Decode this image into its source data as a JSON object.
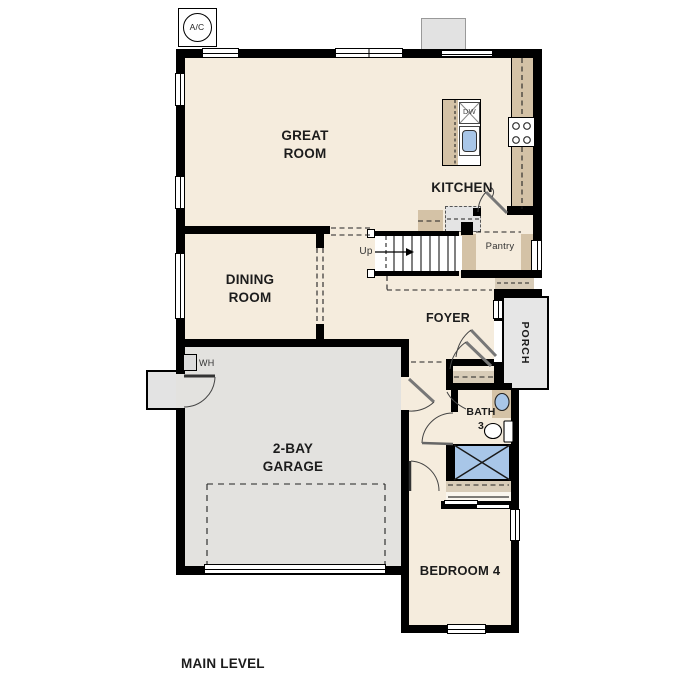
{
  "title": "MAIN LEVEL",
  "labels": {
    "ac": "A/C",
    "great_room": "GREAT\nROOM",
    "kitchen": "KITCHEN",
    "dw": "DW",
    "dining_room": "DINING\nROOM",
    "up": "Up",
    "pantry": "Pantry",
    "foyer": "FOYER",
    "porch": "PORCH",
    "wh": "WH",
    "garage": "2-BAY\nGARAGE",
    "bath": "BATH\n3",
    "bedroom": "BEDROOM 4",
    "level": "MAIN LEVEL"
  },
  "colors": {
    "floor_beige": "#f5ecdd",
    "garage_gray": "#e3e2df",
    "porch_gray": "#e6e6e6",
    "counter_tan": "#d4c2a6",
    "shelf_tan": "#d8ccb8",
    "fixture_blue": "#a8c6e8",
    "wall_black": "#000000"
  },
  "fixtures": [
    "ac-unit",
    "chimney",
    "kitchen-island",
    "dishwasher",
    "kitchen-sink",
    "cooktop",
    "refrigerator",
    "pantry-shelves",
    "stairs",
    "water-heater",
    "stoop",
    "garage-door",
    "coat-closet-shelf",
    "toilet",
    "bath-sink",
    "shower",
    "linen-closet",
    "bypass-doors"
  ]
}
